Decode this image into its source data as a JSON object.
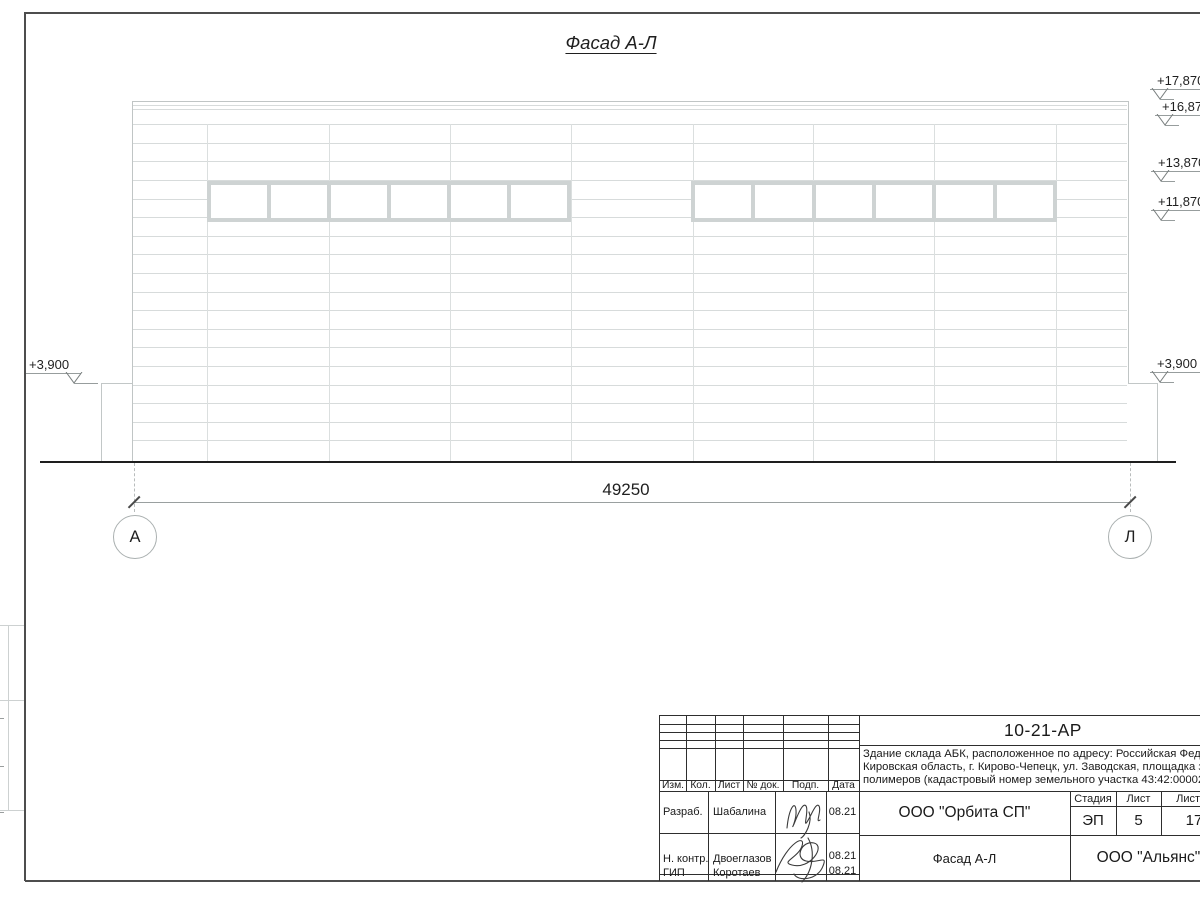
{
  "sheet": {
    "title": "Фасад А-Л",
    "dimension_total": "49250",
    "axis_left": "А",
    "axis_right": "Л",
    "elevations_right": [
      "+17,870",
      "+16,870",
      "+13,870",
      "+11,870",
      "+3,900"
    ],
    "elevations_left": [
      "+3,900"
    ]
  },
  "title_block": {
    "doc_number": "10-21-АР",
    "description_line1": "Здание склада АБК, расположенное по адресу: Российская Федерац",
    "description_line2": "Кировская область, г. Кирово-Чепецк, ул. Заводская, площадка заво",
    "description_line3": "полимеров (кадастровый номер земельного участка 43:42:000022:3",
    "columns": [
      "Изм.",
      "Кол.",
      "Лист",
      "№ док.",
      "Подп.",
      "Дата"
    ],
    "stage_label": "Стадия",
    "sheet_label": "Лист",
    "sheets_label": "Листов",
    "stage_value": "ЭП",
    "sheet_value": "5",
    "sheets_value": "17",
    "rows": [
      {
        "role": "Разраб.",
        "name": "Шабалина",
        "date": "08.21"
      },
      {
        "role": "Н. контр.",
        "name": "Двоеглазов",
        "date": "08.21"
      },
      {
        "role": "ГИП",
        "name": "Коротаев",
        "date": "08.21"
      }
    ],
    "company": "ООО \"Орбита СП\"",
    "drawing_title": "Фасад А-Л",
    "contractor": "ООО \"Альянс\""
  }
}
